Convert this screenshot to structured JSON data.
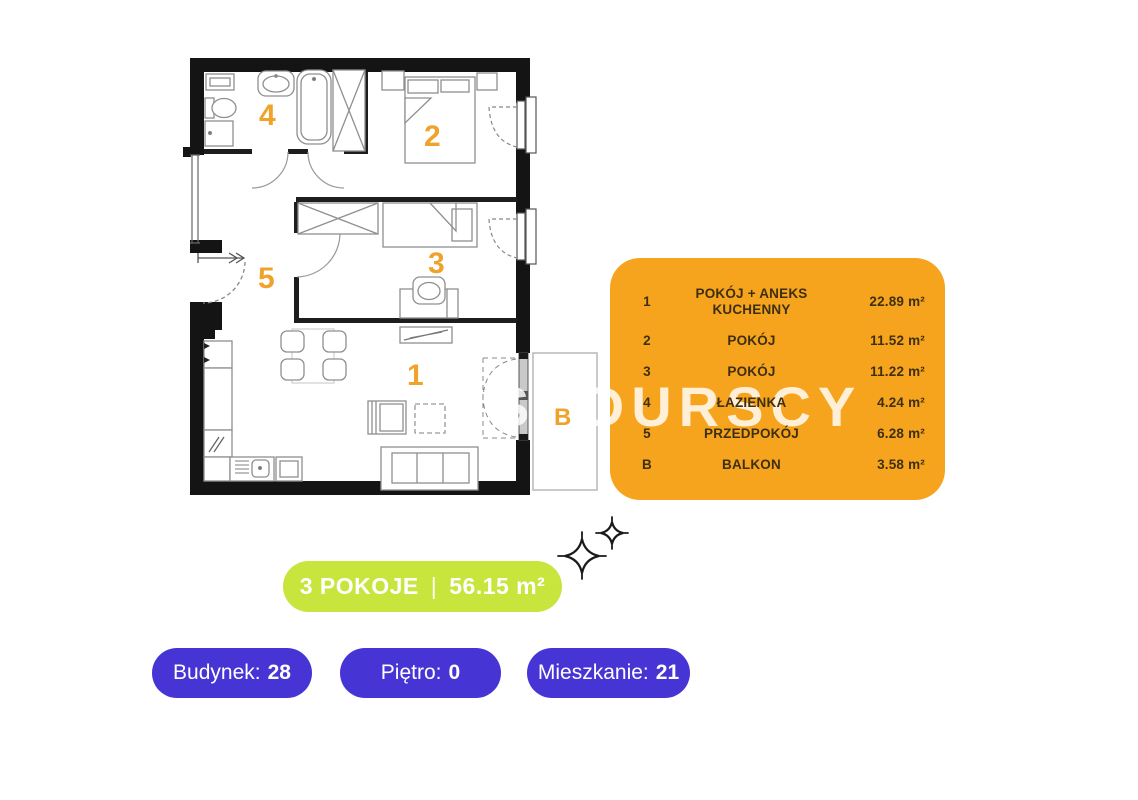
{
  "colors": {
    "legend_bg": "#F6A41D",
    "legend_text": "#3E2F10",
    "summary_bg": "#C7E53C",
    "badge_bg": "#4635D4",
    "room_label": "#EFA32B",
    "wall": "#141414",
    "watermark": "rgba(255,255,255,0.82)"
  },
  "watermark": {
    "text": "SADURSCY"
  },
  "floorplan": {
    "room_labels": {
      "living": "1",
      "bedroom_main": "2",
      "bedroom_small": "3",
      "bathroom": "4",
      "hall": "5",
      "balcony": "B"
    }
  },
  "legend": {
    "rows": [
      {
        "id": "1",
        "name": "POKÓJ + ANEKS KUCHENNY",
        "area": "22.89 m²"
      },
      {
        "id": "2",
        "name": "POKÓJ",
        "area": "11.52 m²"
      },
      {
        "id": "3",
        "name": "POKÓJ",
        "area": "11.22 m²"
      },
      {
        "id": "4",
        "name": "ŁAZIENKA",
        "area": "4.24 m²"
      },
      {
        "id": "5",
        "name": "PRZEDPOKÓJ",
        "area": "6.28 m²"
      },
      {
        "id": "B",
        "name": "BALKON",
        "area": "3.58 m²"
      }
    ]
  },
  "summary": {
    "rooms": "3 POKOJE",
    "separator": "|",
    "area": "56.15 m²"
  },
  "badges": [
    {
      "label": "Budynek:",
      "value": "28"
    },
    {
      "label": "Piętro:",
      "value": "0"
    },
    {
      "label": "Mieszkanie:",
      "value": "21"
    }
  ]
}
